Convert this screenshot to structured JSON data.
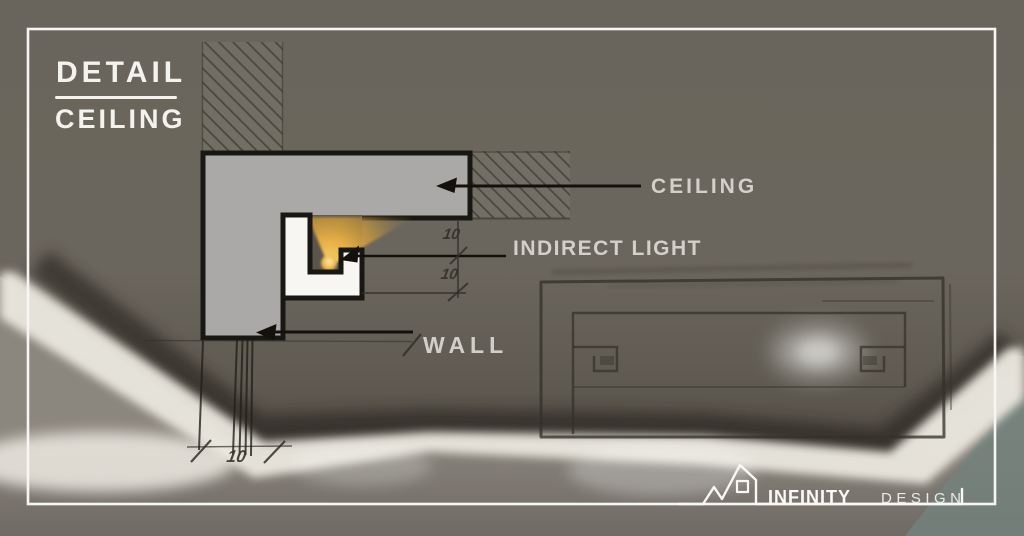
{
  "title": {
    "line1": "DETAIL",
    "line2": "CEILING"
  },
  "callouts": {
    "ceiling": "CEILING",
    "indirect_light": "INDIRECT LIGHT",
    "wall": "WALL"
  },
  "dimensions": {
    "ceiling_offset": "10",
    "cove_depth": "10",
    "wall_thickness": "10"
  },
  "logo": {
    "brand": "INFINITY",
    "suffix": "DESIGN",
    "icon": "house-outline-icon"
  },
  "colors": {
    "glow_amber": "#eab245",
    "led_core": "#ffeab0",
    "section_fill_gray": "#aaa9a7",
    "cove_white": "#f7f6f3",
    "outline_ink": "#191713",
    "label_text": "#d9d6cf",
    "frame_white": "#f7f6f2",
    "photo_panel": "#6b665d",
    "photo_cove_light": "#e9e6dd"
  }
}
